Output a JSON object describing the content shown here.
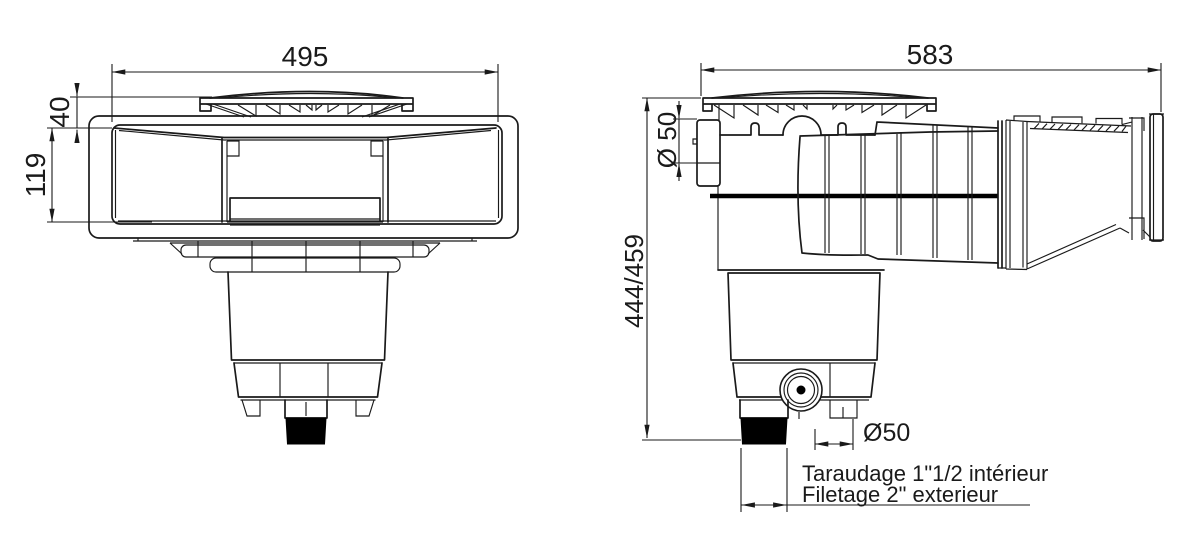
{
  "dimensions": {
    "front_width": "495",
    "front_cover_offset": "40",
    "front_mouth_height": "119",
    "side_length": "583",
    "side_pipe_diameter": "Ø 50",
    "side_overall_height": "444/459",
    "side_outlet_diameter": "Ø50"
  },
  "notes": {
    "line1": "Taraudage 1\"1/2 intérieur",
    "line2": "Filetage 2\" exterieur"
  },
  "colors": {
    "line": "#1a1a1a",
    "background": "#ffffff",
    "outlet_fill": "#000000"
  }
}
